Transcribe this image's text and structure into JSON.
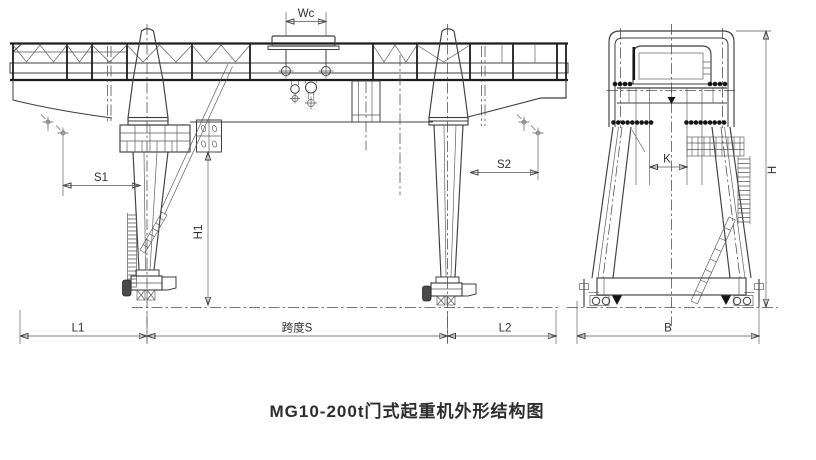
{
  "caption": "MG10-200t门式起重机外形结构图",
  "front_view": {
    "dims": {
      "wc": "Wc",
      "s1": "S1",
      "s2": "S2",
      "h1": "H1",
      "l1": "L1",
      "span": "跨度S",
      "l2": "L2"
    }
  },
  "end_view": {
    "dims": {
      "k": "K",
      "h": "H",
      "b": "B"
    }
  },
  "colors": {
    "line": "#3f3f3f",
    "heavy_line": "#1c1c1c",
    "background": "#ffffff"
  }
}
